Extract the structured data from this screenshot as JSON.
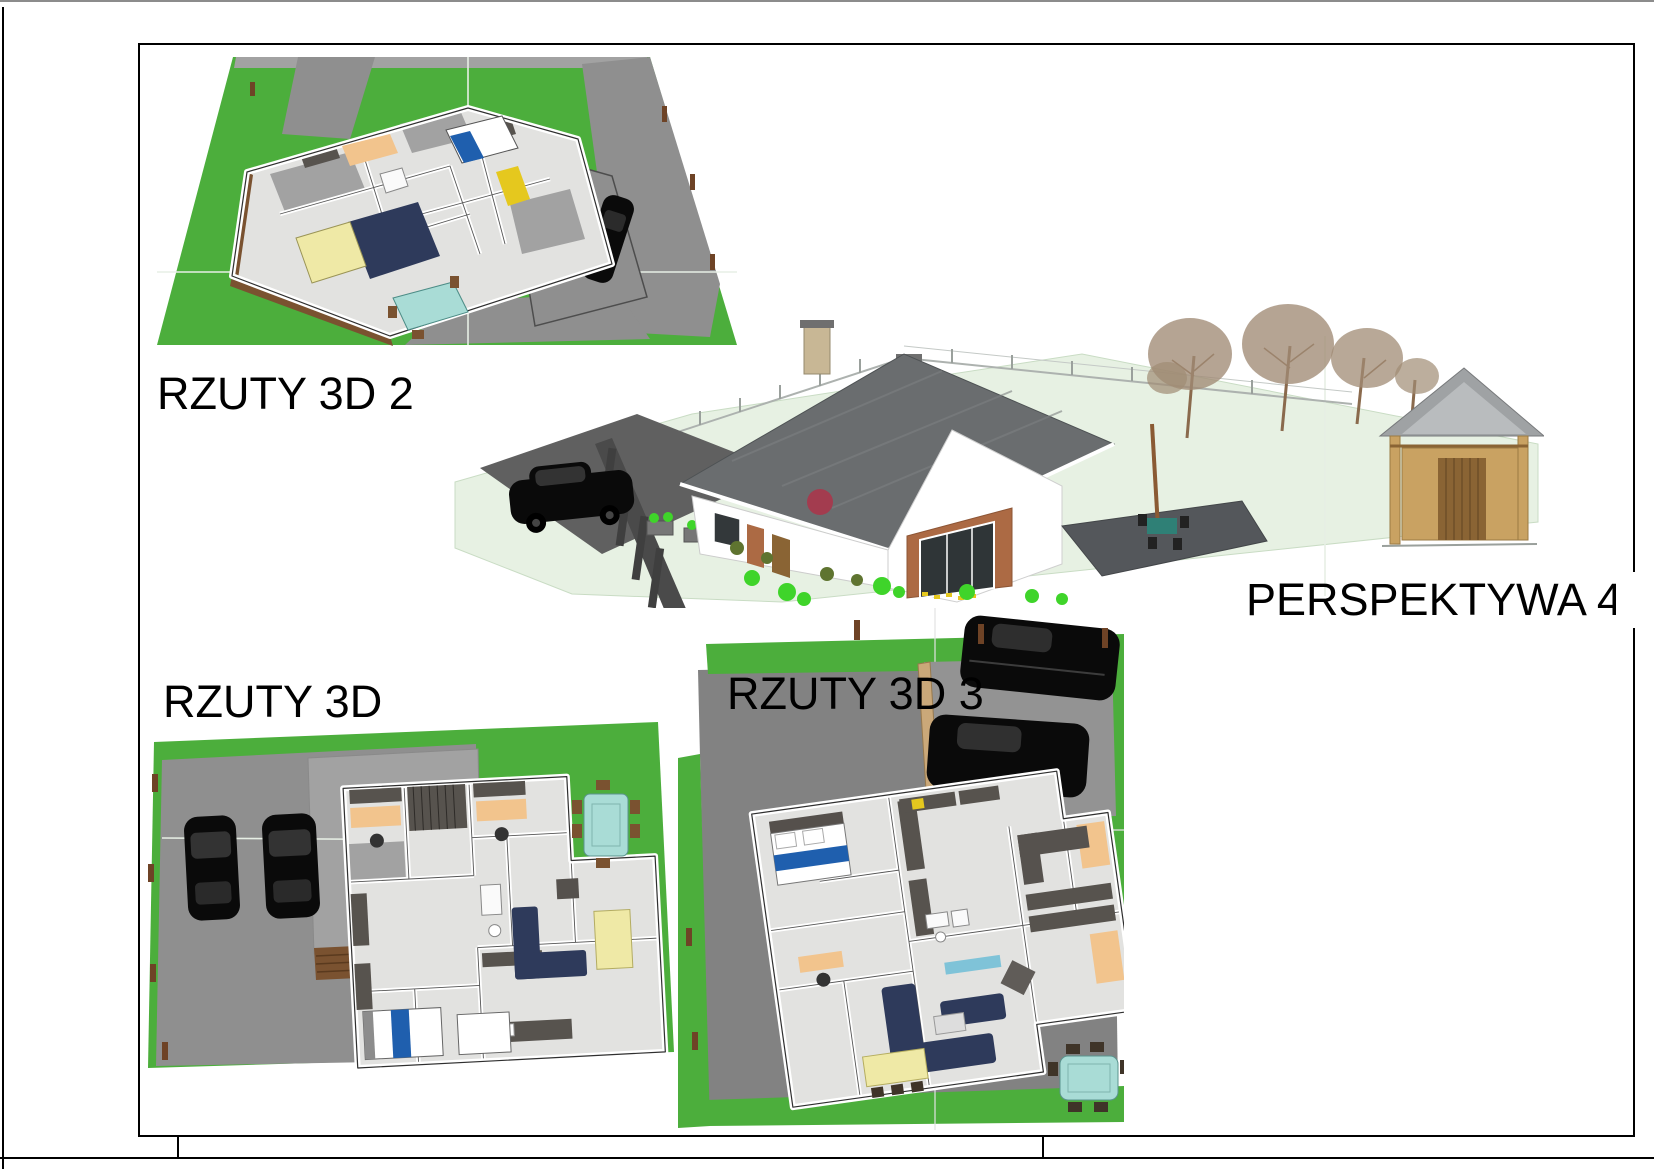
{
  "sheet": {
    "title_labels": {
      "plan_3d_2": "RZUTY 3D 2",
      "perspective_4": "PERSPEKTYWA 4",
      "plan_3d": "RZUTY 3D",
      "plan_3d_3": "RZUTY 3D 3"
    },
    "palette": {
      "grass": "#4CAE3C",
      "road": "#8F8F8F",
      "road_dark": "#828282",
      "pad": "#A2A2A2",
      "pad_light": "#939393",
      "ground_green": "#E7F1E3",
      "roof": "#6A6D6F",
      "roof_light": "#9FA2A4",
      "wall_white": "#FFFFFF",
      "floor": "#E2E2E0",
      "dark_wall": "#57534E",
      "brick": "#AC6A44",
      "wood": "#7A5230",
      "post": "#6E4326",
      "gazebo_wood": "#C9A262",
      "gazebo_door": "#8A6434",
      "navy": "#2E3A5B",
      "yellow_pale": "#EFE9A6",
      "yellow": "#E5C81E",
      "teal": "#A9DCD6",
      "blue": "#1F5FAE",
      "car": "#0A0A0A",
      "orange": "#F2C48D",
      "shrub": "#3FD42A",
      "shrub_olive": "#5F7430",
      "shrub_red": "#A33C4F",
      "tree": "#A08B74",
      "terrace": "#54575B",
      "chimney": "#C8B795",
      "border_black": "#000000",
      "border_gray": "#8C8C8C"
    }
  }
}
